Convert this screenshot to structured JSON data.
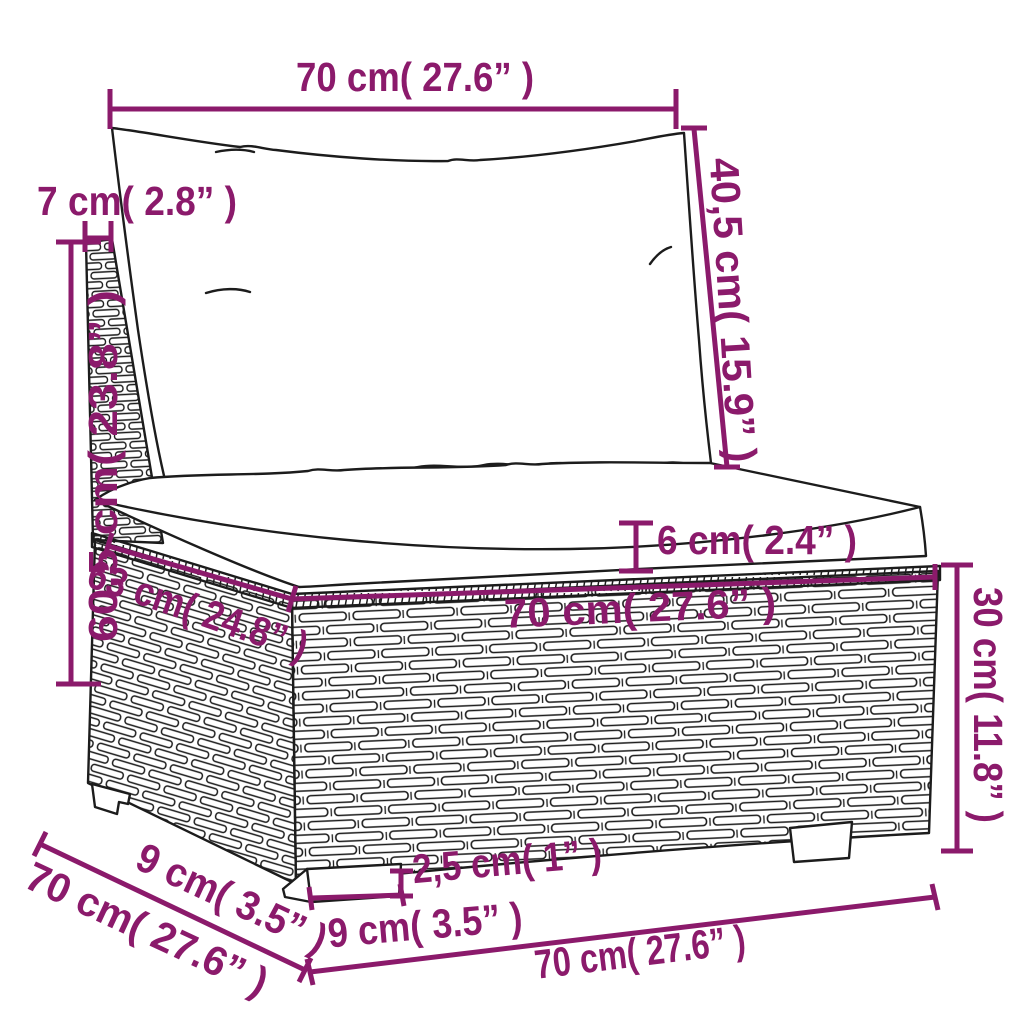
{
  "diagram": {
    "type": "product-dimension-diagram",
    "subject": "poly rattan garden sofa middle section with back pillow and seat cushion",
    "background_color": "#ffffff",
    "dimension_color": "#8B1A6B",
    "outline_color": "#1c1c1c",
    "measurements": [
      {
        "id": "back-cushion-width",
        "cm": "70",
        "in": "27.6",
        "label": "70 cm( 27.6” )"
      },
      {
        "id": "back-post-width",
        "cm": "7",
        "in": "2.8",
        "label": "7 cm( 2.8” )"
      },
      {
        "id": "back-cushion-height",
        "cm": "40,5",
        "in": "15.9",
        "label": "40,5 cm( 15.9” )"
      },
      {
        "id": "overall-height",
        "cm": "60,5",
        "in": "23.8",
        "label": "60,5 cm( 23.8” )"
      },
      {
        "id": "seat-depth",
        "cm": "63",
        "in": "24.8",
        "label": "63 cm( 24.8” )"
      },
      {
        "id": "seat-width",
        "cm": "70",
        "in": "27.6",
        "label": "70 cm( 27.6” )"
      },
      {
        "id": "seat-cushion-thickness",
        "cm": "6",
        "in": "2.4",
        "label": "6 cm( 2.4” )"
      },
      {
        "id": "base-height",
        "cm": "30",
        "in": "11.8",
        "label": "30 cm( 11.8” )"
      },
      {
        "id": "leg-depth",
        "cm": "9",
        "in": "3.5",
        "label": "9 cm( 3.5” )"
      },
      {
        "id": "overall-depth",
        "cm": "70",
        "in": "27.6",
        "label": "70 cm( 27.6” )"
      },
      {
        "id": "leg-width",
        "cm": "9",
        "in": "3.5",
        "label": "9 cm( 3.5” )"
      },
      {
        "id": "leg-height",
        "cm": "2,5",
        "in": "1",
        "label": "2,5 cm( 1” )"
      },
      {
        "id": "base-width",
        "cm": "70",
        "in": "27.6",
        "label": "70 cm( 27.6” )"
      }
    ]
  }
}
